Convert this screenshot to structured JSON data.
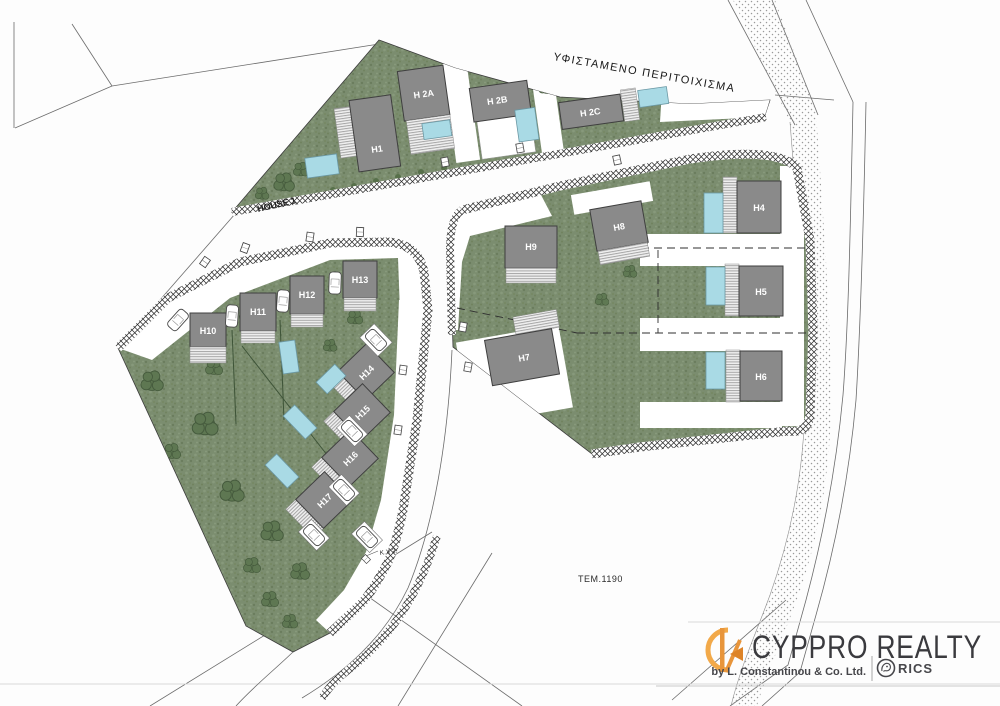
{
  "plan": {
    "perimeter_label": "ΥΦΙΣΤΑΜΕΝΟ ΠΕΡΙΤΟΙΧΙΣΜΑ",
    "road_label": "HOUSE 1",
    "parcel_label": "ΤΕΜ.1190",
    "marker_label": "K.X 2."
  },
  "houses": [
    {
      "label": "H1"
    },
    {
      "label": "H 2A"
    },
    {
      "label": "H 2B"
    },
    {
      "label": "H 2C"
    },
    {
      "label": "H4"
    },
    {
      "label": "H5"
    },
    {
      "label": "H6"
    },
    {
      "label": "H7"
    },
    {
      "label": "H8"
    },
    {
      "label": "H9"
    },
    {
      "label": "H10"
    },
    {
      "label": "H11"
    },
    {
      "label": "H12"
    },
    {
      "label": "H13"
    },
    {
      "label": "H14"
    },
    {
      "label": "H15"
    },
    {
      "label": "H16"
    },
    {
      "label": "H17"
    }
  ],
  "logo": {
    "brand": "CYPPRO REALTY",
    "byline": "by L. Constantinou & Co. Ltd.",
    "affiliation": "RICS"
  },
  "colors": {
    "lawn": "#7B8D6F",
    "tree": "#5D7751",
    "house_fill": "#8A8A8A",
    "pool": "#A9DAE5",
    "logo_accent": "#EDA03F",
    "brand_text": "#3A3A3E"
  }
}
